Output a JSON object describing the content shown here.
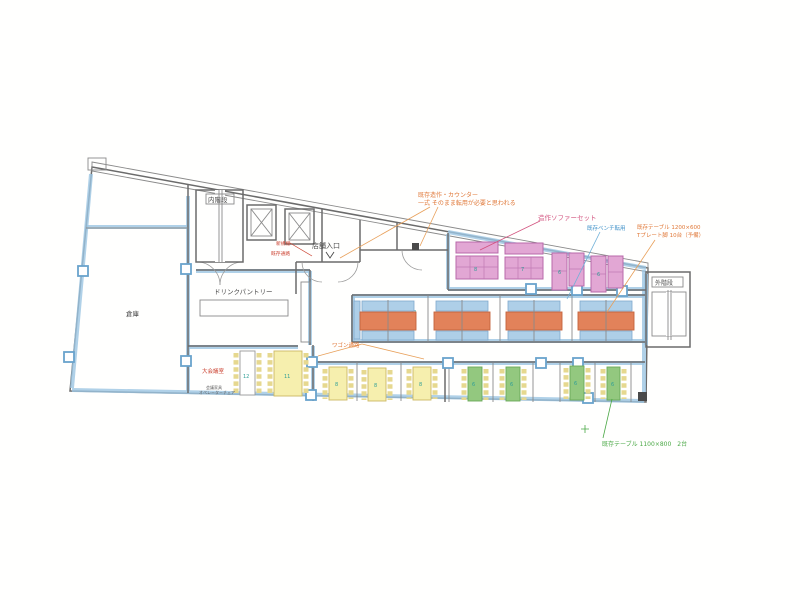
{
  "plan": {
    "rooms": {
      "inner_stair": "内階段",
      "outer_stair": "外階段",
      "entrance": "店舗入口",
      "pantry": "ドリンクパントリー",
      "storage": "倉庫",
      "meeting_room": "大会議室",
      "meeting_note1": "会議家具",
      "meeting_note2": "オペレーターチェア"
    },
    "annotations": {
      "counter_note_line1": "既存造作・カウンター",
      "counter_note_line2": "一式 そのまま転用が必要と思われる",
      "sofa_note": "造作ソファーセット",
      "bench_note": "既存ベンチ転用",
      "table_note_line1": "既存テーブル 1200×600",
      "table_note_line2": "Tプレート脚 10台（予備）",
      "green_note": "既存テーブル 1100×800　2台",
      "aisle_note": "ワゴン通路",
      "shelf_note": "新規棚",
      "corridor_note": "既存通路"
    },
    "seat_counts": {
      "sofa": [
        "8",
        "7",
        "6",
        "6"
      ],
      "desks": [
        "12",
        "11",
        "8",
        "8",
        "8"
      ],
      "booths": [
        "6",
        "6",
        "6",
        "6"
      ],
      "zone_total": "74"
    }
  },
  "colors": {
    "wall": "#6b6b6b",
    "highlight_blue": "#9cc6e2",
    "sofa_pink": "#e2a7d4",
    "table_orange": "#e2825a",
    "bench_blue": "#aecfe8",
    "desk_yellow": "#f6efae",
    "booth_green": "#93c87f",
    "annotation_orange": "#e07838",
    "annotation_pink": "#d2527e",
    "annotation_blue": "#3c8fc8",
    "annotation_green": "#4aa845",
    "annotation_red": "#cc4433",
    "count_teal": "#2f9e96"
  }
}
